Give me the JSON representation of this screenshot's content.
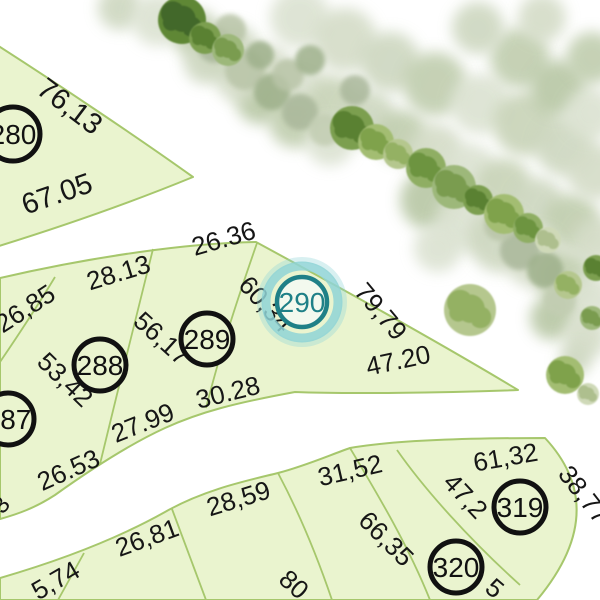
{
  "map": {
    "canvas": {
      "width": 600,
      "height": 600,
      "background": "#ffffff"
    },
    "style": {
      "parcel_fill": "#eaf4cf",
      "parcel_stroke": "#a6c76c",
      "parcel_stroke_width": 2,
      "divider_stroke_width": 1.8,
      "label_color": "#161616",
      "lot_circle_stroke": "#111111",
      "lot_circle_width": 5,
      "lot_font_size": 28,
      "highlight_ring": "#1f8087",
      "highlight_glow": "#8fd4d6",
      "highlight_text": "#1f8087",
      "highlight_fill": "#f3f9ee"
    },
    "parcels": [
      {
        "id": "block-280",
        "d": "M -14,38 C 55,82 140,139 193,177 C 132,202 58,228 -14,250 Z"
      },
      {
        "id": "block-287-290",
        "d": "M 0,278 C 95,256 190,243 256,242 C 350,293 440,343 518,390 C 440,393 345,394 295,392 C 235,403 200,412 165,428 C 130,444 90,470 55,495 C 35,508 18,514 0,519 Z"
      },
      {
        "id": "block-319-320",
        "d": "M 0,578 C 55,562 115,540 165,512 C 205,489 250,480 278,473 C 305,466 330,455 350,448 C 395,440 470,438 545,438 Q 612,510 537,600 L 0,600 Z"
      }
    ],
    "dividers": [
      {
        "id": "div-287-288",
        "d": "M 55,277 C 35,310 15,340 0,362"
      },
      {
        "id": "div-288-289",
        "d": "M 153,249 C 140,300 118,390 100,464"
      },
      {
        "id": "div-289-290",
        "d": "M 257,243 C 240,292 222,345 206,408"
      },
      {
        "id": "div-c1",
        "d": "M 84,553 L 58,600"
      },
      {
        "id": "div-c2",
        "d": "M 172,509 L 206,600"
      },
      {
        "id": "div-c3",
        "d": "M 278,473 C 295,505 315,550 332,600"
      },
      {
        "id": "div-c4",
        "d": "M 350,448 C 378,495 408,545 430,600"
      },
      {
        "id": "div-319-320",
        "d": "M 397,450 C 425,490 470,540 520,585"
      }
    ],
    "lots": [
      {
        "number": "280",
        "x": 13,
        "y": 134,
        "r": 27,
        "highlighted": false
      },
      {
        "number": "287",
        "x": 8,
        "y": 419,
        "r": 26,
        "highlighted": false
      },
      {
        "number": "288",
        "x": 100,
        "y": 365,
        "r": 26,
        "highlighted": false
      },
      {
        "number": "289",
        "x": 207,
        "y": 339,
        "r": 26,
        "highlighted": false
      },
      {
        "number": "290",
        "x": 302,
        "y": 302,
        "r": 25,
        "highlighted": true
      },
      {
        "number": "319",
        "x": 520,
        "y": 507,
        "r": 26,
        "highlighted": false
      },
      {
        "number": "320",
        "x": 456,
        "y": 567,
        "r": 26,
        "highlighted": false
      }
    ],
    "dimensions": [
      {
        "text": "76,13",
        "x": 64,
        "y": 114,
        "rot": 37,
        "size": 29
      },
      {
        "text": "67.05",
        "x": 60,
        "y": 203,
        "rot": -19,
        "size": 29
      },
      {
        "text": "26,85",
        "x": 30,
        "y": 316,
        "rot": -33,
        "size": 26
      },
      {
        "text": "28.13",
        "x": 121,
        "y": 281,
        "rot": -17,
        "size": 26
      },
      {
        "text": "26.36",
        "x": 226,
        "y": 247,
        "rot": -16,
        "size": 26
      },
      {
        "text": "56,17",
        "x": 156,
        "y": 345,
        "rot": 42,
        "size": 26
      },
      {
        "text": "53,42",
        "x": 59,
        "y": 386,
        "rot": 44,
        "size": 26
      },
      {
        "text": "60,34",
        "x": 259,
        "y": 310,
        "rot": 48,
        "size": 26
      },
      {
        "text": "27.99",
        "x": 146,
        "y": 431,
        "rot": -22,
        "size": 26
      },
      {
        "text": "30.28",
        "x": 230,
        "y": 401,
        "rot": -14,
        "size": 26
      },
      {
        "text": "26.53",
        "x": 72,
        "y": 478,
        "rot": -24,
        "size": 26
      },
      {
        "text": "79,79",
        "x": 374,
        "y": 317,
        "rot": 50,
        "size": 26
      },
      {
        "text": "47.20",
        "x": 400,
        "y": 369,
        "rot": -12,
        "size": 26
      },
      {
        "text": "3",
        "x": 7,
        "y": 510,
        "rot": -50,
        "size": 24
      },
      {
        "text": "5,74",
        "x": 60,
        "y": 588,
        "rot": -30,
        "size": 26
      },
      {
        "text": "26,81",
        "x": 150,
        "y": 546,
        "rot": -20,
        "size": 26
      },
      {
        "text": "28,59",
        "x": 241,
        "y": 507,
        "rot": -17,
        "size": 26
      },
      {
        "text": "31,52",
        "x": 352,
        "y": 479,
        "rot": -13,
        "size": 26
      },
      {
        "text": "66,35",
        "x": 380,
        "y": 545,
        "rot": 45,
        "size": 26
      },
      {
        "text": "80",
        "x": 288,
        "y": 591,
        "rot": 42,
        "size": 26
      },
      {
        "text": "61,32",
        "x": 507,
        "y": 466,
        "rot": -10,
        "size": 26
      },
      {
        "text": "47,2",
        "x": 459,
        "y": 502,
        "rot": 47,
        "size": 26
      },
      {
        "text": "38,77",
        "x": 577,
        "y": 500,
        "rot": 52,
        "size": 26
      },
      {
        "text": "5",
        "x": 489,
        "y": 595,
        "rot": 40,
        "size": 26
      }
    ],
    "trees": {
      "palette_soft": [
        "#cdd7c0",
        "#dbe2d1",
        "#c0cdae",
        "#d4dcc7",
        "#c8d3b7",
        "#b8c7a5",
        "#e1e7d8"
      ],
      "palette_mid": [
        "#aab89b",
        "#b9c5a8",
        "#9fb18c",
        "#c2cdb2"
      ],
      "palette_sharp": [
        [
          "#8fae64",
          "#6d9440"
        ],
        [
          "#a3bd72",
          "#7fa24c"
        ],
        [
          "#7c9f50",
          "#5a8133"
        ],
        [
          "#b5c78e",
          "#94b163"
        ],
        [
          "#9db87a",
          "#7a9c50"
        ],
        [
          "#cfd9b8",
          "#aebf8e"
        ],
        [
          "#5e8736",
          "#43682a"
        ]
      ],
      "soft": [
        [
          120,
          8,
          22,
          0
        ],
        [
          158,
          20,
          26,
          1
        ],
        [
          196,
          34,
          24,
          2
        ],
        [
          232,
          52,
          28,
          0
        ],
        [
          266,
          70,
          26,
          3
        ],
        [
          300,
          86,
          28,
          1
        ],
        [
          334,
          102,
          26,
          4
        ],
        [
          368,
          118,
          28,
          0
        ],
        [
          402,
          136,
          26,
          2
        ],
        [
          436,
          152,
          28,
          3
        ],
        [
          470,
          170,
          26,
          1
        ],
        [
          504,
          186,
          28,
          4
        ],
        [
          538,
          204,
          26,
          0
        ],
        [
          572,
          222,
          28,
          2
        ],
        [
          596,
          242,
          24,
          3
        ],
        [
          300,
          18,
          30,
          1
        ],
        [
          345,
          40,
          32,
          3
        ],
        [
          390,
          62,
          30,
          0
        ],
        [
          435,
          84,
          32,
          2
        ],
        [
          480,
          104,
          30,
          1
        ],
        [
          525,
          124,
          32,
          4
        ],
        [
          565,
          146,
          30,
          0
        ],
        [
          595,
          172,
          28,
          3
        ],
        [
          520,
          58,
          30,
          2
        ],
        [
          558,
          88,
          28,
          5
        ],
        [
          590,
          114,
          26,
          1
        ],
        [
          478,
          28,
          26,
          0
        ],
        [
          542,
          18,
          24,
          3
        ],
        [
          592,
          58,
          26,
          2
        ],
        [
          430,
          200,
          30,
          5
        ],
        [
          465,
          222,
          30,
          1
        ],
        [
          500,
          240,
          32,
          0
        ],
        [
          535,
          258,
          30,
          3
        ],
        [
          565,
          280,
          28,
          2
        ],
        [
          590,
          300,
          26,
          1
        ],
        [
          552,
          318,
          22,
          5
        ],
        [
          585,
          338,
          22,
          3
        ],
        [
          260,
          100,
          24,
          5
        ],
        [
          295,
          122,
          26,
          2
        ],
        [
          330,
          142,
          24,
          1
        ],
        [
          238,
          80,
          22,
          3
        ],
        [
          206,
          62,
          22,
          0
        ],
        [
          438,
          248,
          24,
          1
        ],
        [
          575,
          360,
          16,
          0
        ]
      ],
      "mid": [
        [
          215,
          45,
          18,
          0
        ],
        [
          245,
          70,
          20,
          1
        ],
        [
          272,
          92,
          18,
          2
        ],
        [
          300,
          112,
          18,
          0
        ],
        [
          325,
          130,
          16,
          3
        ],
        [
          260,
          55,
          14,
          2
        ],
        [
          288,
          75,
          16,
          1
        ],
        [
          520,
          250,
          20,
          0
        ],
        [
          545,
          270,
          18,
          2
        ],
        [
          500,
          225,
          16,
          1
        ],
        [
          560,
          300,
          16,
          3
        ],
        [
          230,
          30,
          16,
          1
        ],
        [
          310,
          60,
          15,
          2
        ],
        [
          355,
          90,
          15,
          0
        ]
      ],
      "sharp": [
        [
          182,
          20,
          24,
          6
        ],
        [
          205,
          38,
          16,
          2
        ],
        [
          228,
          50,
          16,
          4
        ],
        [
          352,
          128,
          22,
          2
        ],
        [
          376,
          142,
          18,
          1
        ],
        [
          398,
          154,
          15,
          3
        ],
        [
          426,
          168,
          20,
          0
        ],
        [
          454,
          187,
          22,
          4
        ],
        [
          478,
          200,
          15,
          2
        ],
        [
          504,
          214,
          20,
          1
        ],
        [
          528,
          228,
          15,
          0
        ],
        [
          548,
          240,
          13,
          5
        ],
        [
          470,
          310,
          26,
          3
        ],
        [
          565,
          375,
          19,
          1
        ],
        [
          588,
          394,
          11,
          5
        ],
        [
          596,
          268,
          13,
          2
        ],
        [
          568,
          285,
          14,
          3
        ],
        [
          592,
          318,
          12,
          4
        ]
      ]
    }
  }
}
